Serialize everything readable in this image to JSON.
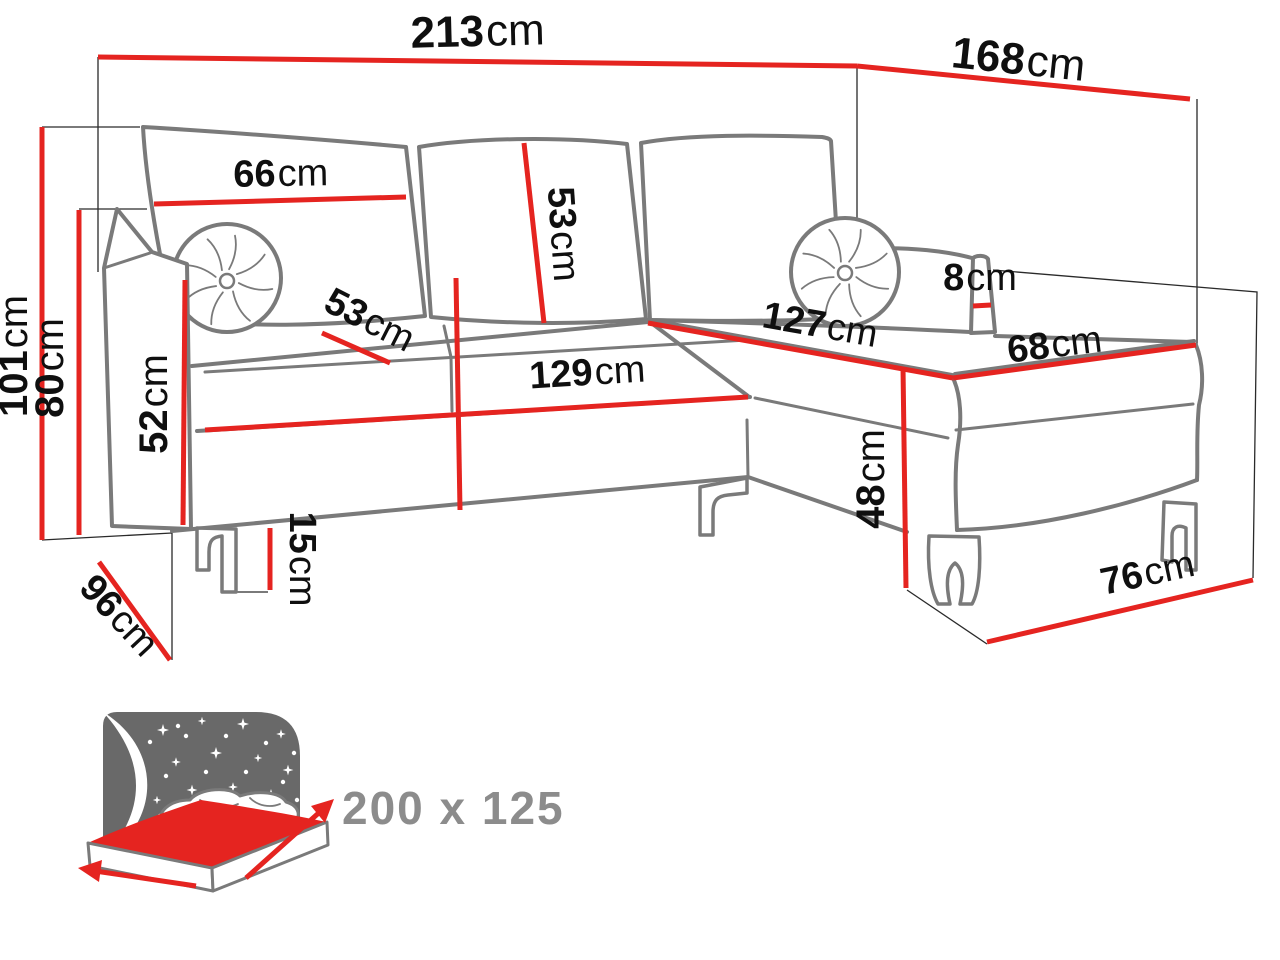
{
  "title": "Corner sofa-bed dimensions diagram",
  "colors": {
    "dimension_red": "#e52420",
    "sofa_outline_gray": "#7a7a7a",
    "label_black": "#0f0f0f",
    "icon_gray": "#696969",
    "sleeping_label_gray": "#8c8c8c",
    "background": "#ffffff"
  },
  "dims": {
    "d213": {
      "value": "213",
      "unit": "cm"
    },
    "d168": {
      "value": "168",
      "unit": "cm"
    },
    "d101": {
      "value": "101",
      "unit": "cm"
    },
    "d80": {
      "value": "80",
      "unit": "cm"
    },
    "d66": {
      "value": "66",
      "unit": "cm"
    },
    "d53_back": {
      "value": "53",
      "unit": "cm"
    },
    "d53_seat": {
      "value": "53",
      "unit": "cm"
    },
    "d52": {
      "value": "52",
      "unit": "cm"
    },
    "d129": {
      "value": "129",
      "unit": "cm"
    },
    "d127": {
      "value": "127",
      "unit": "cm"
    },
    "d68": {
      "value": "68",
      "unit": "cm"
    },
    "d8": {
      "value": "8",
      "unit": "cm"
    },
    "d48": {
      "value": "48",
      "unit": "cm"
    },
    "d15": {
      "value": "15",
      "unit": "cm"
    },
    "d96": {
      "value": "96",
      "unit": "cm"
    },
    "d76": {
      "value": "76",
      "unit": "cm"
    }
  },
  "sleeping_area": {
    "label": "200 x 125"
  }
}
